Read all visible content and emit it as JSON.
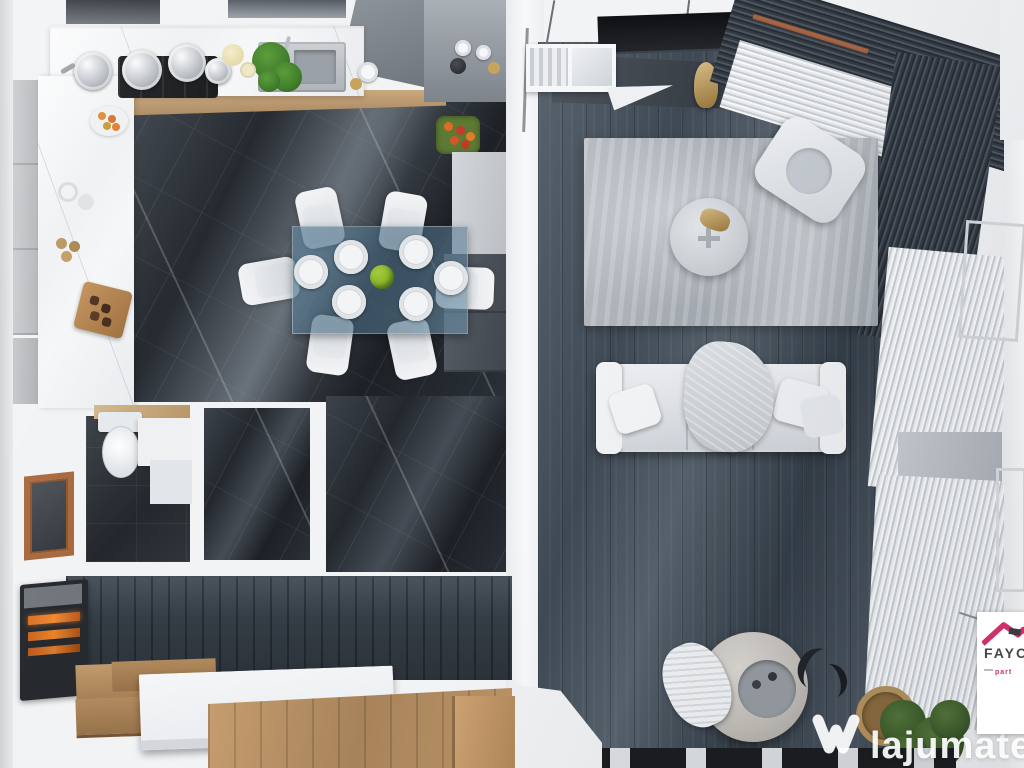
{
  "watermark": {
    "brand": "lajumate",
    "tld": ".ro",
    "icon": "lajumate-w-heart-icon"
  },
  "partner_badge": {
    "name": "FAYO",
    "subtitle": "part",
    "icon": "pink-roof-house-icon"
  },
  "scene": {
    "type": "3d-rendered-top-down-floor-plan",
    "rooms": [
      {
        "name": "kitchen",
        "floor": "white-marble-counters",
        "furniture": [
          "l-shaped-marble-counter",
          "upper-cabinets",
          "extractor-hood",
          "gas-stove-with-pots",
          "sink-with-herb-plant",
          "lemonade-pitcher",
          "coffee-machine-and-cups",
          "serving-board",
          "red-flower-box",
          "tall-grey-cabinet"
        ]
      },
      {
        "name": "dining-area",
        "floor": "dark-marble",
        "furniture": [
          "glass-dining-table",
          "six-white-chairs",
          "six-place-settings",
          "green-apple-centerpiece"
        ]
      },
      {
        "name": "living-room",
        "floor": "dark-grey-wood-planks",
        "furniture": [
          "tv-console",
          "wall-tv",
          "display-shelf",
          "gold-statue",
          "light-grey-area-rug",
          "round-coffee-table",
          "white-armchair",
          "three-seat-white-sofa",
          "throw-blanket",
          "pouf-with-tray",
          "dark-sculpture",
          "potted-plant-in-basket",
          "striped-runner",
          "dark-and-sheer-curtains",
          "windows"
        ]
      },
      {
        "name": "bathroom",
        "floor": "dark-tile",
        "furniture": [
          "toilet",
          "wood-shelf",
          "vanity",
          "orange-framed-window"
        ]
      },
      {
        "name": "storage-niche",
        "floor": "dark-marble",
        "furniture": []
      },
      {
        "name": "hallway",
        "floor": "oak-wood",
        "furniture": [
          "electric-fireplace",
          "wooden-staircase",
          "white-stair-landing"
        ]
      }
    ]
  },
  "palette": {
    "wall_white": "#f1f3f5",
    "marble_floor_dark": "#23282e",
    "living_floor": "#3f4954",
    "rug_grey": "#b6bac0",
    "glass_table_blue": "#5e84a0",
    "stair_wood": "#b08758",
    "fireplace_orange": "#e07b28",
    "bathroom_window_frame": "#a8683c",
    "watermark_white": "#ffffff",
    "watermark_tld_teal": "#96d8c9",
    "badge_pink": "#cf2f6a",
    "badge_text_grey": "#45454d"
  }
}
